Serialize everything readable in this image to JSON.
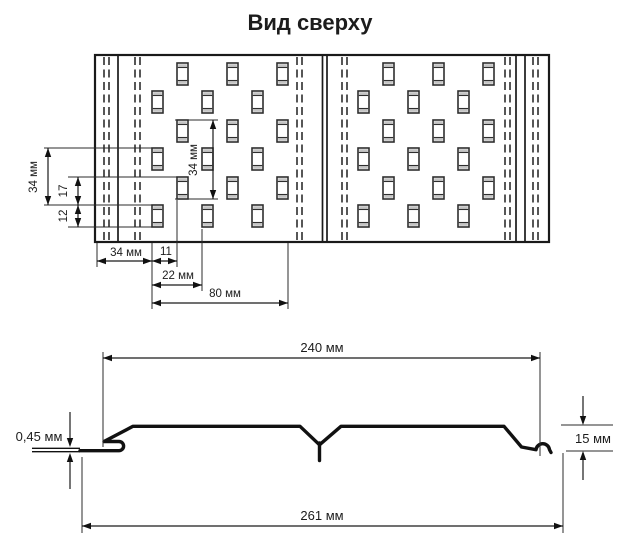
{
  "title": "Вид сверху",
  "colors": {
    "line": "#1a1a1a",
    "profile": "#111111",
    "dashed": "#3a3a3a",
    "perf_stroke": "#2e2e2e",
    "perf_cap": "#c4c4c4",
    "text": "#1c1c1c",
    "background": "#ffffff"
  },
  "top_view": {
    "dims": {
      "v_row_pitch": "34 мм",
      "v_row_offset": "17",
      "v_slot_height": "12",
      "v_inner_pitch": "34 мм",
      "h_edge_to_slot": "34 мм",
      "h_row_shift": "11",
      "h_second_shift": "22 мм",
      "h_group_width": "80 мм"
    },
    "perforation": {
      "slot_w": 11,
      "slot_h": 22,
      "row_y_a": [
        91,
        148,
        205
      ],
      "row_y_b": [
        63,
        120,
        177
      ],
      "cols_a": [
        152,
        202,
        252,
        358,
        408,
        458
      ],
      "cols_b": [
        177,
        227,
        277,
        383,
        433,
        483
      ]
    }
  },
  "profile_view": {
    "dims": {
      "top_width": "240 мм",
      "thickness": "0,45 мм",
      "height": "15 мм",
      "total_width": "261 мм"
    }
  }
}
